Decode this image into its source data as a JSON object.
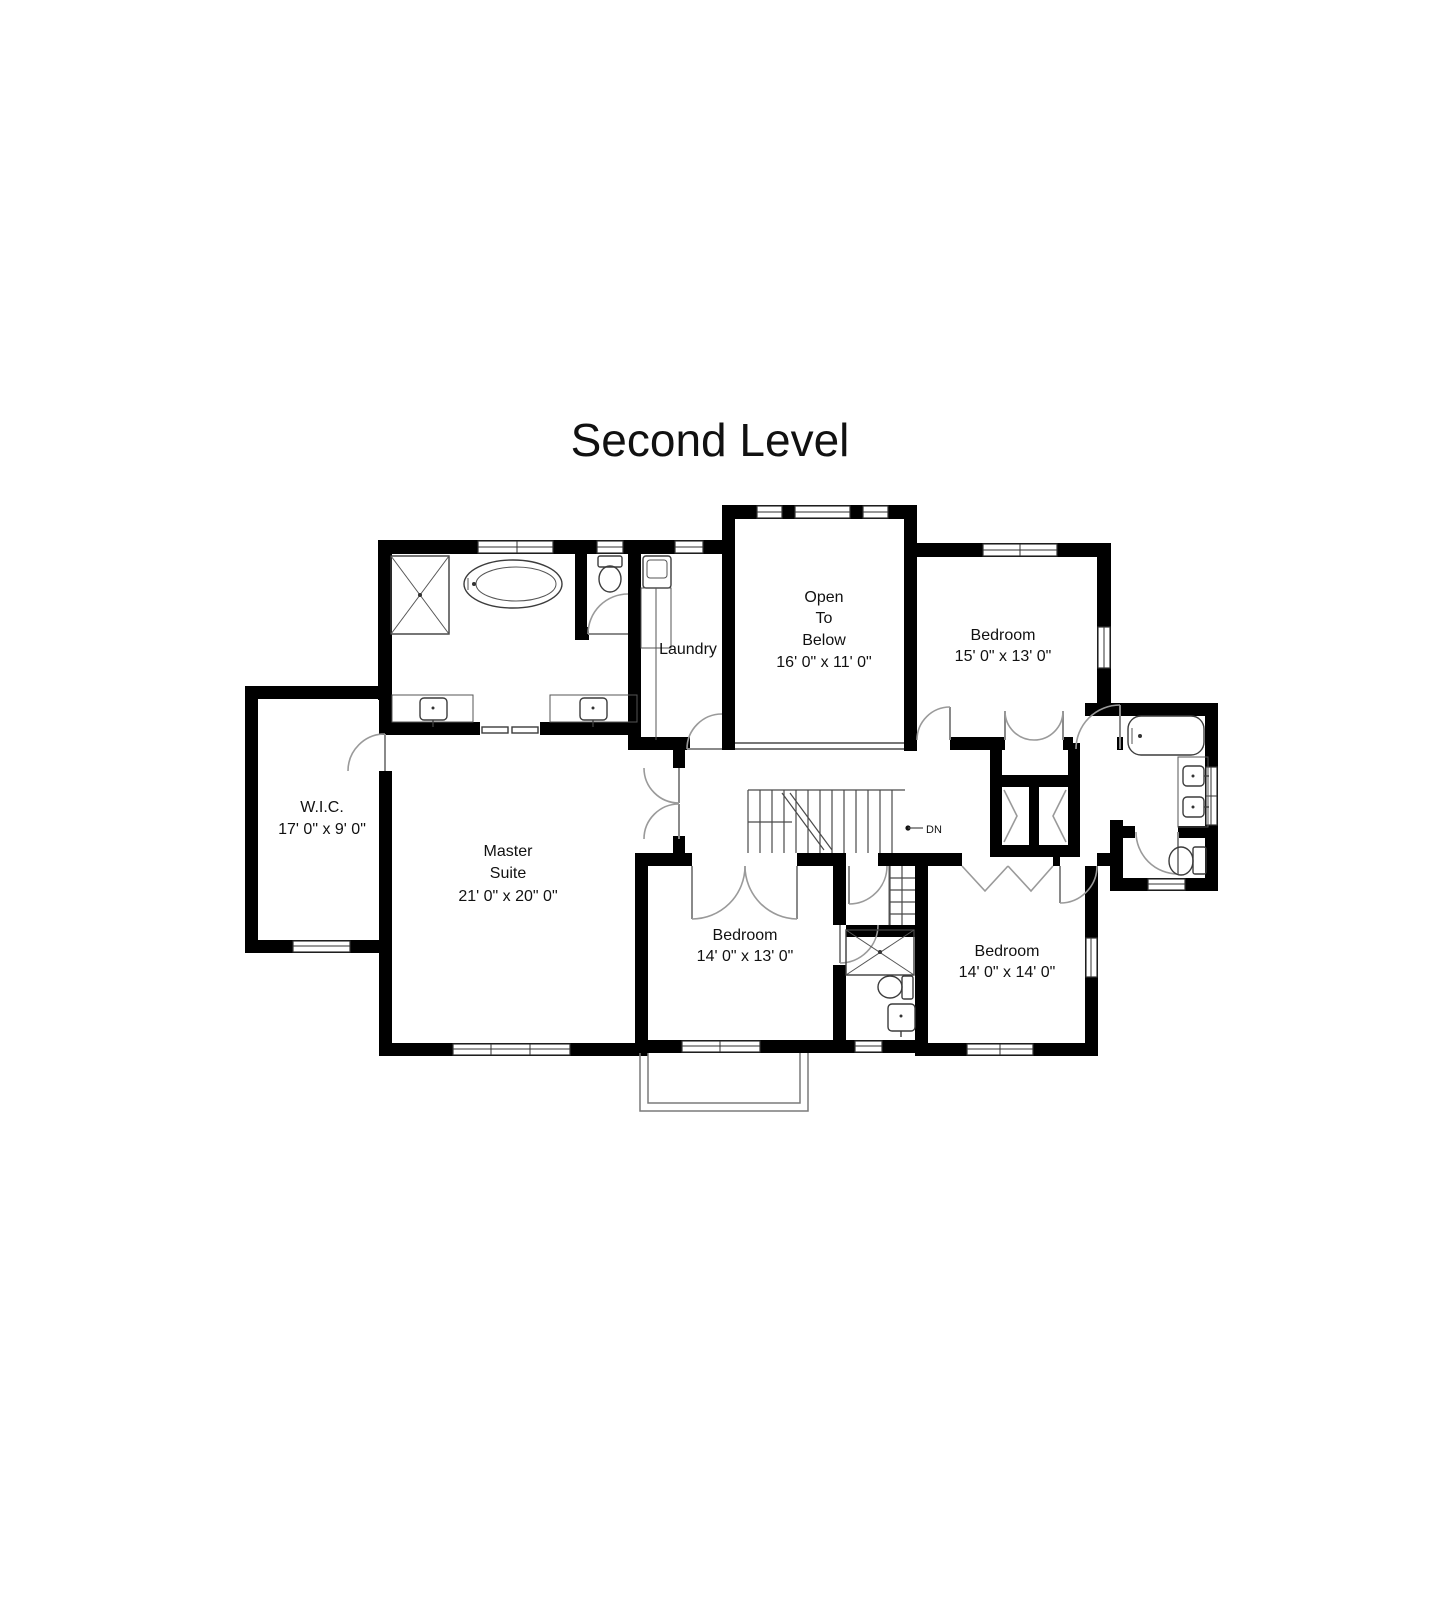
{
  "title": "Second Level",
  "rooms": {
    "wic": {
      "name": "W.I.C.",
      "dims": "17' 0\" x 9' 0\""
    },
    "master": {
      "line1": "Master",
      "line2": "Suite",
      "dims": "21' 0\" x 20\" 0\""
    },
    "laundry": {
      "name": "Laundry"
    },
    "open_to_below": {
      "line1": "Open",
      "line2": "To",
      "line3": "Below",
      "dims": "16' 0\" x 11' 0\""
    },
    "bedroom_top_right": {
      "name": "Bedroom",
      "dims": "15' 0\" x 13' 0\""
    },
    "bedroom_bottom_middle": {
      "name": "Bedroom",
      "dims": "14' 0\" x 13' 0\""
    },
    "bedroom_bottom_right": {
      "name": "Bedroom",
      "dims": "14' 0\" x 14' 0\""
    }
  },
  "stairs": {
    "down_label": "DN"
  },
  "colors": {
    "wall": "#000000",
    "fixture_line": "#3c3c3c",
    "text": "#111111",
    "background": "#ffffff"
  }
}
